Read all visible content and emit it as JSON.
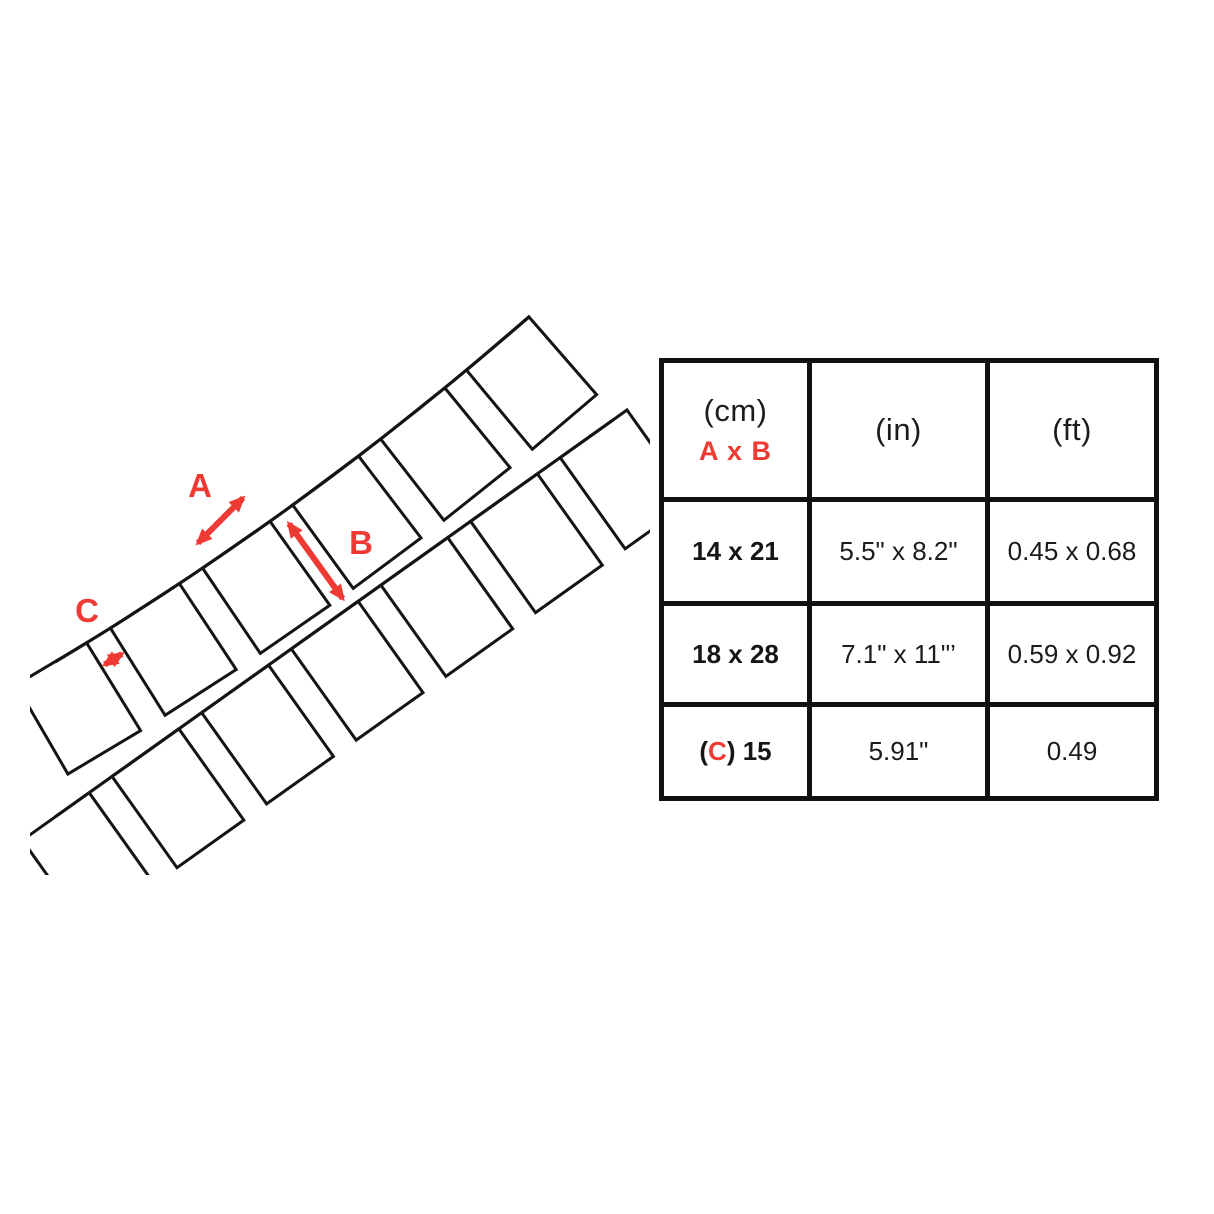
{
  "colors": {
    "accent": "#ef3a34",
    "ink": "#141414"
  },
  "diagram": {
    "labels": {
      "a": "A",
      "b": "B",
      "c": "C"
    }
  },
  "table": {
    "header": {
      "cm_unit": "(cm)",
      "cm_sub": "A x B",
      "in_unit": "(in)",
      "ft_unit": "(ft)"
    },
    "rows": [
      {
        "cm": "14 x 21",
        "in": "5.5\" x 8.2\"",
        "ft": "0.45 x 0.68"
      },
      {
        "cm": "18 x 28",
        "in": "7.1\" x 11\"’",
        "ft": "0.59 x 0.92"
      },
      {
        "cm_open": "(",
        "cm_c": "C",
        "cm_close": ") 15",
        "in": "5.91\"",
        "ft": "0.49"
      }
    ]
  }
}
